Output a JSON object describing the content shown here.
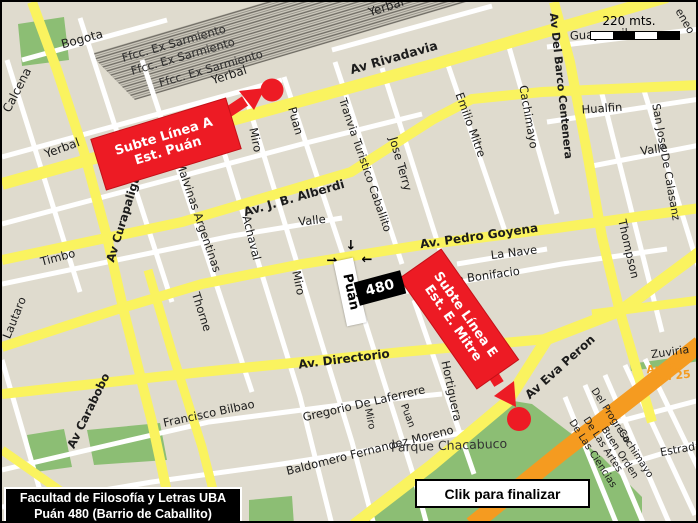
{
  "title_box": {
    "line1": "Facultad de Filosofía y Letras UBA",
    "line2": "Puán 480 (Barrio de Caballito)"
  },
  "finish_button": {
    "label": "Clik para finalizar"
  },
  "scale_bar": {
    "label": "220 mts."
  },
  "markers": {
    "subte_a": {
      "line1": "Subte Línea A",
      "line2": "Est. Puán"
    },
    "subte_e": {
      "line1": "Subte Línea E",
      "line2": "Est. E. Mitre"
    },
    "building": {
      "number": "480",
      "street_tag": "Puán"
    }
  },
  "colors": {
    "background": "#DFDBCE",
    "road_major": "#FAF35F",
    "road_minor": "#FFFFFF",
    "park": "#8CBE74",
    "highway_orange": "#F59B20",
    "marker_red": "#ED1B24",
    "railway_gray": "#CFCBBF"
  },
  "pointer_arrows": [
    {
      "g": "↓",
      "x": 349,
      "y": 244
    },
    {
      "g": "→",
      "x": 330,
      "y": 259
    },
    {
      "g": "←",
      "x": 365,
      "y": 258
    }
  ],
  "street_labels": [
    {
      "t": "Bogota",
      "x": 80,
      "y": 37,
      "r": -15,
      "s": 12
    },
    {
      "t": "Calcena",
      "x": 15,
      "y": 88,
      "r": -63,
      "s": 12
    },
    {
      "t": "Yerbal",
      "x": 60,
      "y": 146,
      "r": -20,
      "s": 12
    },
    {
      "t": "Yerbal",
      "x": 227,
      "y": 73,
      "r": -18,
      "s": 12
    },
    {
      "t": "Yerbal",
      "x": 384,
      "y": 5,
      "r": -18,
      "s": 12
    },
    {
      "t": "Ffcc. Ex Sarmiento",
      "x": 172,
      "y": 42,
      "r": -16,
      "s": 11.5,
      "c": "#2e2e2e"
    },
    {
      "t": "Ffcc. Ex Sarmiento",
      "x": 181,
      "y": 55,
      "r": -16,
      "s": 11.5,
      "c": "#2e2e2e"
    },
    {
      "t": "Ffcc. Ex Sarmiento",
      "x": 209,
      "y": 67,
      "r": -16,
      "s": 11.5,
      "c": "#2e2e2e"
    },
    {
      "t": "Av Rivadavia",
      "x": 392,
      "y": 56,
      "r": -16,
      "s": 12.5,
      "w": 700
    },
    {
      "t": "Av. J. B. Alberdi",
      "x": 292,
      "y": 196,
      "r": -16,
      "s": 12,
      "w": 700
    },
    {
      "t": "Av. Pedro Goyena",
      "x": 477,
      "y": 234,
      "r": -8,
      "s": 12,
      "w": 700
    },
    {
      "t": "Av. Directorio",
      "x": 342,
      "y": 357,
      "r": -7,
      "s": 12,
      "w": 700
    },
    {
      "t": "Av Eva Peron",
      "x": 558,
      "y": 365,
      "r": -42,
      "s": 12,
      "w": 700
    },
    {
      "t": "Av Curapaligüe",
      "x": 123,
      "y": 213,
      "r": -73,
      "s": 11.5,
      "w": 700
    },
    {
      "t": "Av Carabobo",
      "x": 87,
      "y": 409,
      "r": -64,
      "s": 11.5,
      "w": 700
    },
    {
      "t": "Av Del Barco Centenera",
      "x": 559,
      "y": 84,
      "r": 84,
      "s": 11,
      "w": 700
    },
    {
      "t": "Malvinas Argentinas",
      "x": 196,
      "y": 215,
      "r": 71,
      "s": 11.5
    },
    {
      "t": "Achaval",
      "x": 249,
      "y": 236,
      "r": 76,
      "s": 11.5
    },
    {
      "t": "Miro",
      "x": 253,
      "y": 138,
      "r": 78,
      "s": 11.5
    },
    {
      "t": "Miro",
      "x": 296,
      "y": 281,
      "r": 78,
      "s": 11.5
    },
    {
      "t": "Miro",
      "x": 367,
      "y": 417,
      "r": 78,
      "s": 10
    },
    {
      "t": "Puan",
      "x": 293,
      "y": 119,
      "r": 74,
      "s": 11.5
    },
    {
      "t": "Puan",
      "x": 405,
      "y": 414,
      "r": 70,
      "s": 10
    },
    {
      "t": "Tranvia Turistico Caballito",
      "x": 363,
      "y": 163,
      "r": 71,
      "s": 11
    },
    {
      "t": "Jose Terry",
      "x": 398,
      "y": 162,
      "r": 74,
      "s": 11.5
    },
    {
      "t": "Valle",
      "x": 310,
      "y": 219,
      "r": -6,
      "s": 11.5
    },
    {
      "t": "Valle",
      "x": 652,
      "y": 148,
      "r": -8,
      "s": 11.5
    },
    {
      "t": "Timbo",
      "x": 56,
      "y": 256,
      "r": -15,
      "s": 11.5
    },
    {
      "t": "Thorne",
      "x": 199,
      "y": 310,
      "r": 72,
      "s": 11.5
    },
    {
      "t": "Lautaro",
      "x": 13,
      "y": 316,
      "r": -68,
      "s": 11.5
    },
    {
      "t": "Emilio Mitre",
      "x": 468,
      "y": 123,
      "r": 70,
      "s": 11.5
    },
    {
      "t": "Cachimayo",
      "x": 526,
      "y": 115,
      "r": 80,
      "s": 11.5
    },
    {
      "t": "Hualfin",
      "x": 600,
      "y": 107,
      "r": -4,
      "s": 11.5
    },
    {
      "t": "Guayaquil",
      "x": 597,
      "y": 33,
      "r": -3,
      "s": 11.5
    },
    {
      "t": "San Jose De Calasanz",
      "x": 664,
      "y": 160,
      "r": 80,
      "s": 11
    },
    {
      "t": "Thompson",
      "x": 626,
      "y": 247,
      "r": 77,
      "s": 11.5
    },
    {
      "t": "La Nave",
      "x": 512,
      "y": 251,
      "r": -7,
      "s": 11.5
    },
    {
      "t": "Jose Bonifacio",
      "x": 478,
      "y": 275,
      "r": -8,
      "s": 11.5
    },
    {
      "t": "Hortiguera",
      "x": 449,
      "y": 389,
      "r": 78,
      "s": 11.5
    },
    {
      "t": "Gregorio De Laferrere",
      "x": 362,
      "y": 402,
      "r": -13,
      "s": 11.5
    },
    {
      "t": "Francisco Bilbao",
      "x": 207,
      "y": 412,
      "r": -12,
      "s": 11.5
    },
    {
      "t": "Baldomero Fernandez Moreno",
      "x": 368,
      "y": 449,
      "r": -14,
      "s": 11.5
    },
    {
      "t": "Parque Chacabuco",
      "x": 447,
      "y": 444,
      "r": -2,
      "s": 12.5,
      "c": "#333333"
    },
    {
      "t": "Zuviria",
      "x": 668,
      "y": 350,
      "r": -8,
      "s": 11
    },
    {
      "t": "Estrada",
      "x": 679,
      "y": 447,
      "r": -10,
      "s": 11
    },
    {
      "t": "Del Progreso",
      "x": 608,
      "y": 414,
      "r": 57,
      "s": 10
    },
    {
      "t": "De Las Artes",
      "x": 600,
      "y": 443,
      "r": 57,
      "s": 10
    },
    {
      "t": "Buen Orden",
      "x": 617,
      "y": 451,
      "r": 57,
      "s": 10
    },
    {
      "t": "Cachimayo",
      "x": 633,
      "y": 452,
      "r": 57,
      "s": 10
    },
    {
      "t": "De Las Ciencias",
      "x": 590,
      "y": 452,
      "r": 57,
      "s": 10
    },
    {
      "t": "eneo",
      "x": 683,
      "y": 19,
      "r": 60,
      "s": 11
    },
    {
      "t": "Au 25",
      "x": 662,
      "y": 366,
      "r": -6,
      "s": 11,
      "w": 700,
      "c": "#F59B20"
    },
    {
      "t": "Au 25",
      "x": 671,
      "y": 374,
      "r": -6,
      "s": 11,
      "w": 700,
      "c": "#F59B20"
    }
  ]
}
